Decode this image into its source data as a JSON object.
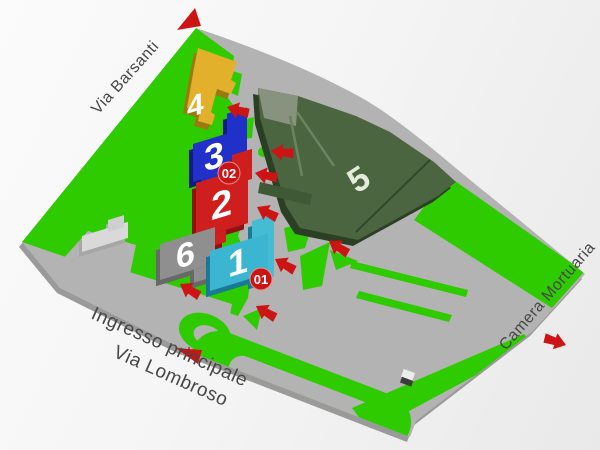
{
  "streets": {
    "via_barsanti": "Via Barsanti",
    "ingresso_line1": "Ingresso principale",
    "ingresso_line2": "Via Lombroso",
    "camera_mortuaria": "Camera Mortuaria"
  },
  "buildings": [
    {
      "number": "1",
      "badge": "01",
      "color": "#3cb6d0"
    },
    {
      "number": "2",
      "color": "#ce1e1e"
    },
    {
      "number": "3",
      "badge": "02",
      "color": "#2030c8"
    },
    {
      "number": "4",
      "color": "#e2b02a"
    },
    {
      "number": "5",
      "color": "#4a6540"
    },
    {
      "number": "6",
      "color": "#8f8f8f"
    }
  ],
  "colors": {
    "grass": "#2ecb00",
    "road": "#b3b3b3",
    "road_shadow": "#9a9a9a",
    "arrow": "#cc1414",
    "badge": "#cc1414",
    "white_building": "#d9d9d9"
  }
}
